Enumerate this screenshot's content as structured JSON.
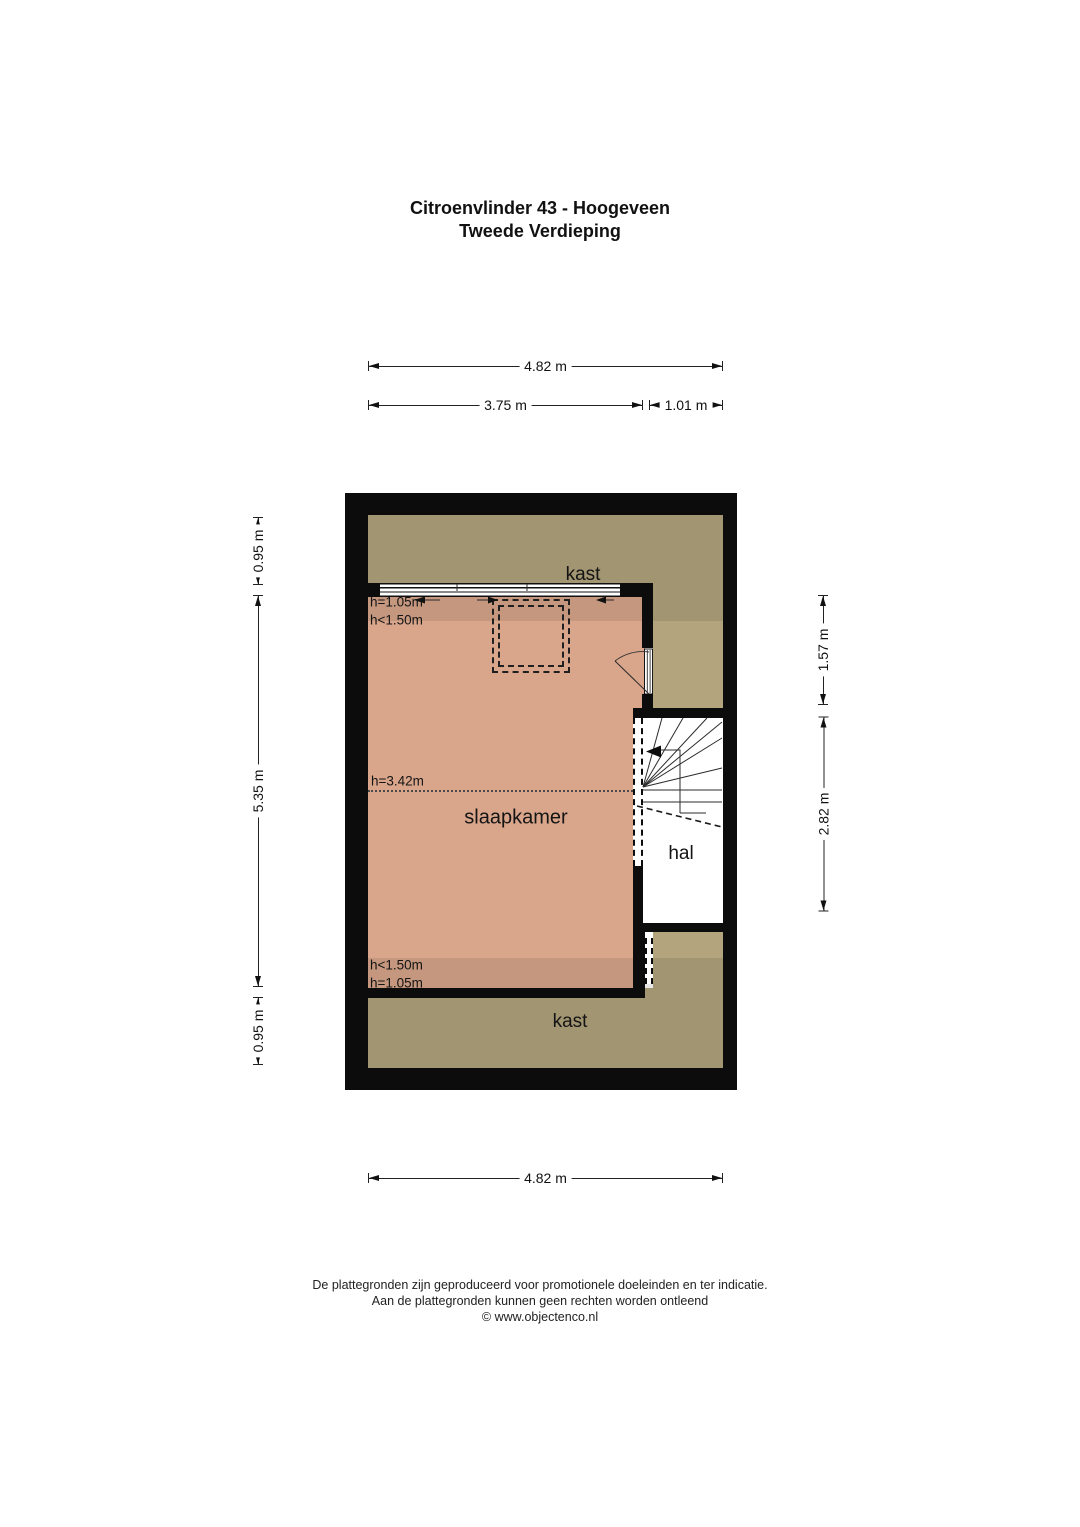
{
  "title": {
    "line1": "Citroenvlinder 43 - Hoogeveen",
    "line2": "Tweede Verdieping"
  },
  "dims": {
    "top_total": "4.82 m",
    "top_left": "3.75 m",
    "top_right": "1.01 m",
    "left_top": "0.95 m",
    "left_middle": "5.35 m",
    "left_bottom": "0.95 m",
    "right_top": "1.57 m",
    "right_bottom": "2.82 m",
    "bottom_total": "4.82 m"
  },
  "rooms": {
    "kast_top": "kast",
    "slaapkamer": "slaapkamer",
    "hal": "hal",
    "kast_bottom": "kast"
  },
  "heights": {
    "top_knee": "h=1.05m",
    "top_low": "h<1.50m",
    "ridge": "h=3.42m",
    "bottom_low": "h<1.50m",
    "bottom_knee": "h=1.05m"
  },
  "footer": {
    "line1": "De plattegronden zijn geproduceerd voor promotionele doeleinden en ter indicatie.",
    "line2": "Aan de plattegronden kunnen geen rechten worden ontleend",
    "line3": "© www.objectenco.nl"
  },
  "colors": {
    "wall": "#0c0c0c",
    "bedroom": "#d9a68b",
    "closet": "#b3a47e",
    "floor": "#ffffff",
    "line": "#222222",
    "text": "#1a1a1a"
  }
}
